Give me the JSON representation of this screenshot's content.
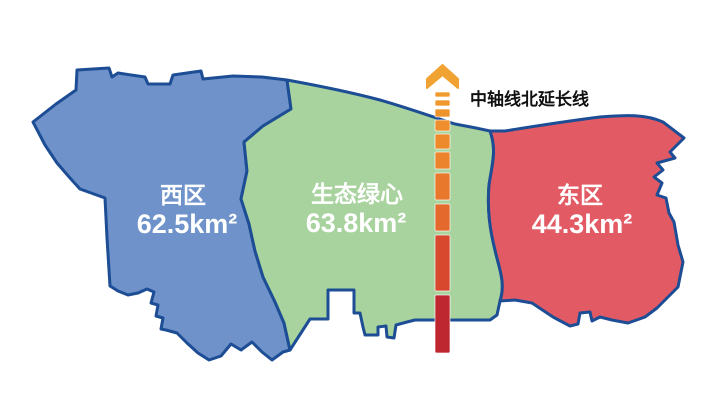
{
  "map": {
    "background_color": "#FFFFFF",
    "border_color": "#1D4D94",
    "regions": [
      {
        "id": "west",
        "name": "西区",
        "area": "62.5km²",
        "fill": "#6E92C9",
        "label_color": "#FFFFFF"
      },
      {
        "id": "green-heart",
        "name": "生态绿心",
        "area": "63.8km²",
        "fill": "#A8D39E",
        "label_color": "#FFFFFF"
      },
      {
        "id": "east",
        "name": "东区",
        "area": "44.3km²",
        "fill": "#E25A64",
        "label_color": "#FFFFFF"
      }
    ],
    "axis_marker": {
      "label": "中轴线北延长线",
      "label_color": "#111111",
      "arrow_color": "#F0A232",
      "dash_colors": [
        "#F09B2E",
        "#F0982E",
        "#EF932D",
        "#EE8E2D",
        "#ED8A2C",
        "#EB842C",
        "#E8782B",
        "#E4692C",
        "#D8482F",
        "#BF2730"
      ]
    }
  }
}
